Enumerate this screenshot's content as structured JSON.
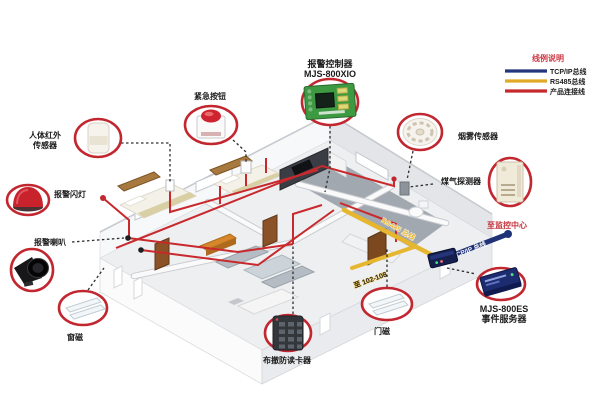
{
  "legend": {
    "title": "线例说明",
    "items": [
      {
        "label": "TCP/IP总线",
        "color": "#24357e"
      },
      {
        "label": "RS485总线",
        "color": "#e2a928"
      },
      {
        "label": "产品连接线",
        "color": "#c5292e"
      }
    ]
  },
  "devices": {
    "controller": {
      "line1": "报警控制器",
      "line2": "MJS-800XIO"
    },
    "emergency_button": {
      "label": "紧急按钮"
    },
    "pir_sensor": {
      "line1": "人体红外",
      "line2": "传感器"
    },
    "alarm_strobe": {
      "label": "报警闪灯"
    },
    "alarm_horn": {
      "label": "报警喇叭"
    },
    "window_magnet": {
      "label": "窗磁"
    },
    "card_reader": {
      "label": "布撤防读卡器"
    },
    "door_magnet": {
      "label": "门磁"
    },
    "smoke_sensor": {
      "label": "烟雾传感器"
    },
    "gas_detector": {
      "label": "煤气探测器"
    },
    "event_server": {
      "line1": "MJS-800ES",
      "line2": "事件服务器"
    }
  },
  "bus_labels": {
    "to_monitoring_center": "至监控中心",
    "tcpip_bus": "TCP/IP 总线",
    "rs485_bus": "RS485 总线",
    "to_rooms": "至 102-108"
  },
  "colors": {
    "ring_red": "#c22730",
    "product_line_red": "#c8292c",
    "bus_yellow": "#e7b62f",
    "bus_navy": "#1f3277",
    "label_dark": "#1b1b1b",
    "legend_title_red": "#cc3a44"
  }
}
